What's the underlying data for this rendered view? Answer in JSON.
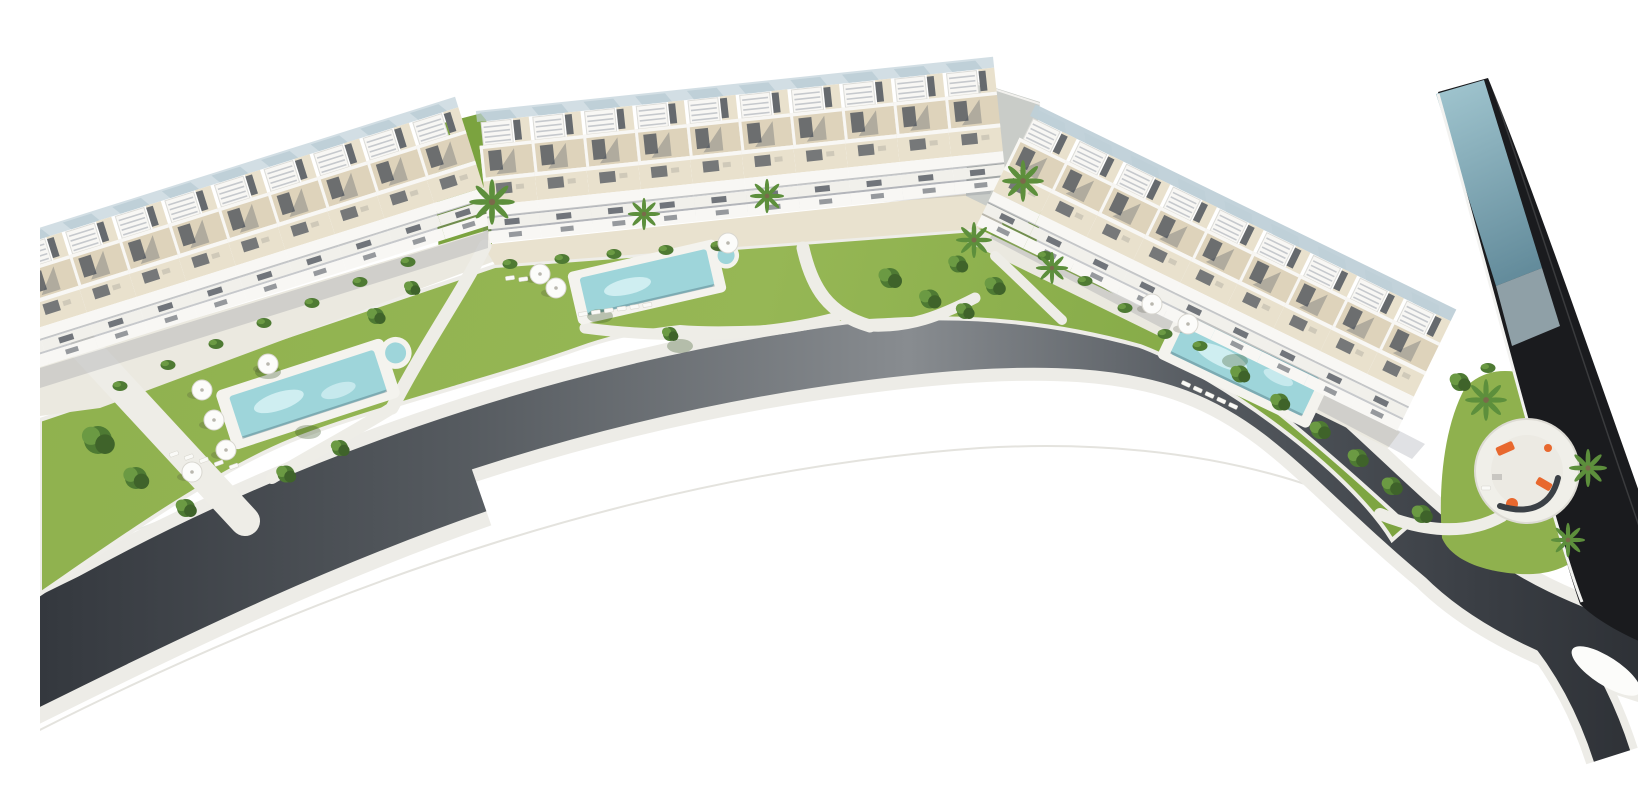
{
  "meta": {
    "title": "Aerial 3D render — curved residential development with three townhouse rows, gardens, pools and road",
    "media_type": "architectural-render",
    "visible_text": "none"
  },
  "palette": {
    "bg": "#ffffff",
    "road_dark": "#34383e",
    "road_mid": "#888c90",
    "road_edge": "#2b2e33",
    "curb": "#edece7",
    "faint": "#e4e3de",
    "lawn": "#8fb14e",
    "lawn_deep": "#7ba33f",
    "tree": "#4e7a33",
    "tree_light": "#6b9a43",
    "tree_deep": "#3f632a",
    "palm_green": "#5d8f3c",
    "path_light": "#eeede7",
    "plaza_gray": "#ebe9e0",
    "plaza_sand": "#e9e2cf",
    "wall_white": "#f8f7f4",
    "terrace": "#ded3bb",
    "terrace_light": "#e9e1cd",
    "window_dark": "#454c56",
    "slat": "#c6c9cd",
    "roof_glass": "#bfd0d8",
    "pool_deck": "#f4f3ee",
    "pool_water": "#9ed5da",
    "pool_light": "#cfeef1",
    "band_dark": "#1a1b1e",
    "band_glass_light": "#9dc2cc",
    "band_glass_dark": "#567f90",
    "accent_orange": "#e8682e",
    "bench": "#3b4046"
  },
  "scene": {
    "background": "white, overexposed sky area with faint road hairlines",
    "buildings": [
      {
        "id": "west-row",
        "label": "West townhouse row",
        "units": 10,
        "angle_deg": -17.5,
        "style": "stepped roof terraces, white pergolas, beige decks"
      },
      {
        "id": "north-row",
        "label": "North townhouse row",
        "units": 10,
        "angle_deg": -6,
        "style": "stepped roof terraces, white pergolas, beige decks"
      },
      {
        "id": "east-row",
        "label": "East townhouse row",
        "units": 9,
        "angle_deg": 26,
        "style": "stepped roof terraces with pale blue glass roof panes"
      },
      {
        "id": "dark-strip",
        "label": "Dark glass building strip",
        "orientation": "diagonal, upper right to lower right",
        "facade": "near-black with teal glass top section"
      }
    ],
    "amenities": {
      "pools": [
        {
          "id": "west-pool",
          "type": "lap pool with round spa",
          "angle_deg": -18
        },
        {
          "id": "central-pool",
          "type": "lap pool with round spa",
          "angle_deg": -13
        },
        {
          "id": "east-pool",
          "type": "long lap pool",
          "angle_deg": 25
        }
      ],
      "playground": {
        "location": "south-east corner pocket",
        "equipment_color": "orange",
        "bench": "curved dark bench",
        "palms": 3
      },
      "umbrella_count": 10,
      "lounger_rows": 4,
      "palm_count": 9
    },
    "road": {
      "description": "wide asphalt road sweeping in an arc from the west edge around the south of the site to a fork at the south-east",
      "markings": "none visible",
      "curbs": "light concrete curb on both sides",
      "fork_island": "white teardrop island at south-east junction"
    },
    "landscape": {
      "lawns": "yellow-green lawn band between buildings and road",
      "paths": "light concrete paths crossing lawns",
      "vegetation": "clipped shrubs along facades, shade trees with cast shadows, palms at entrances"
    }
  }
}
